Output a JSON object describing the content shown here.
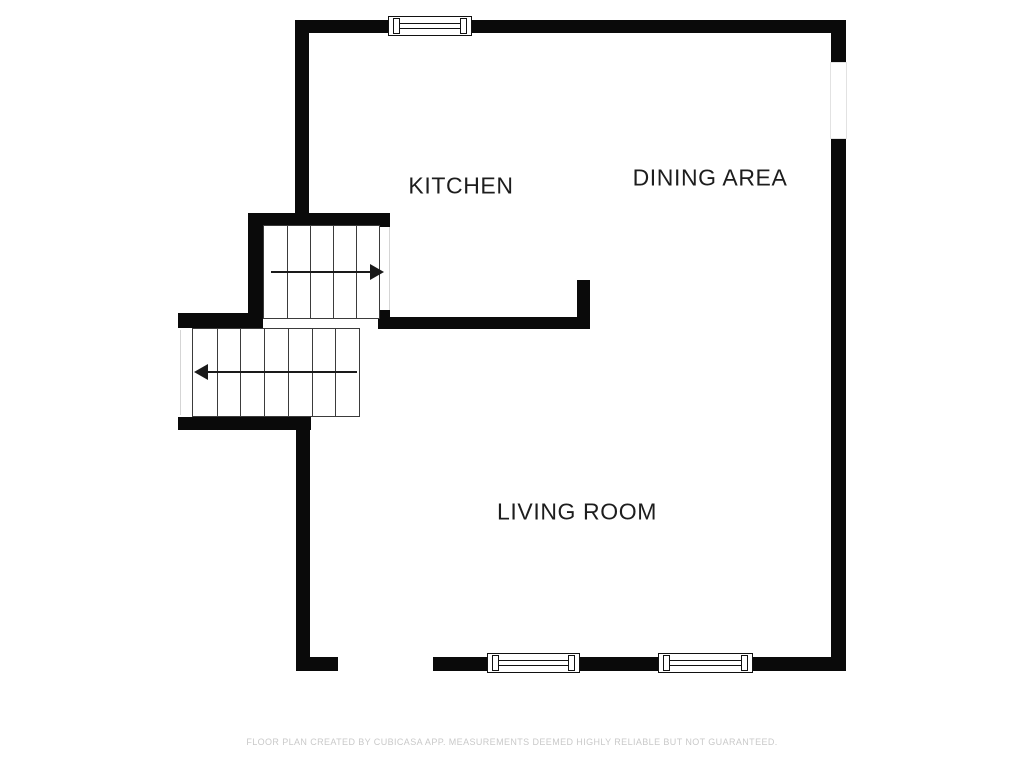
{
  "meta": {
    "canvas": {
      "width": 1024,
      "height": 768
    },
    "colors": {
      "background": "#ffffff",
      "wall": "#0a0a0a",
      "tread_line": "#3b3b3b",
      "arrow": "#1a1a1a",
      "window_frame": "#111111",
      "faint_edge": "#d5d5d5",
      "label_text": "#1d1d1d",
      "footer_text": "#c9c9c9"
    }
  },
  "rooms": [
    {
      "name": "kitchen",
      "label": "KITCHEN",
      "cx": 461,
      "cy": 186
    },
    {
      "name": "dining-area",
      "label": "DINING AREA",
      "cx": 710,
      "cy": 178
    },
    {
      "name": "living-room",
      "label": "LIVING ROOM",
      "cx": 577,
      "cy": 512
    }
  ],
  "walls": [
    {
      "name": "top-wall",
      "x": 295,
      "y": 20,
      "w": 551,
      "h": 13
    },
    {
      "name": "right-wall-upper",
      "x": 831,
      "y": 20,
      "w": 15,
      "h": 43
    },
    {
      "name": "right-wall-lower",
      "x": 831,
      "y": 139,
      "w": 15,
      "h": 531
    },
    {
      "name": "bottom-wall-left-corner",
      "x": 296,
      "y": 657,
      "w": 42,
      "h": 14
    },
    {
      "name": "bottom-wall-seg-2",
      "x": 433,
      "y": 657,
      "w": 54,
      "h": 14
    },
    {
      "name": "bottom-wall-seg-3",
      "x": 580,
      "y": 657,
      "w": 78,
      "h": 14
    },
    {
      "name": "bottom-wall-seg-4",
      "x": 753,
      "y": 657,
      "w": 93,
      "h": 14
    },
    {
      "name": "living-room-left-wall",
      "x": 296,
      "y": 430,
      "w": 14,
      "h": 241
    },
    {
      "name": "kitchen-left-wall",
      "x": 295,
      "y": 20,
      "w": 14,
      "h": 207
    },
    {
      "name": "stairs-top-wall",
      "x": 248,
      "y": 213,
      "w": 142,
      "h": 14
    },
    {
      "name": "stairs-left-wall",
      "x": 248,
      "y": 213,
      "w": 15,
      "h": 105
    },
    {
      "name": "stairs-mid-wall-left",
      "x": 178,
      "y": 313,
      "w": 85,
      "h": 15
    },
    {
      "name": "interior-wall",
      "x": 378,
      "y": 317,
      "w": 212,
      "h": 12
    },
    {
      "name": "interior-wall-nib",
      "x": 378,
      "y": 310,
      "w": 12,
      "h": 8
    },
    {
      "name": "interior-wall-stub",
      "x": 577,
      "y": 280,
      "w": 13,
      "h": 38
    },
    {
      "name": "stairs-bottom-wall",
      "x": 178,
      "y": 417,
      "w": 133,
      "h": 13
    }
  ],
  "windows": [
    {
      "name": "top-window",
      "style": "framed",
      "x": 388,
      "y": 16,
      "w": 84,
      "h": 20
    },
    {
      "name": "bottom-window-1",
      "style": "framed",
      "x": 487,
      "y": 653,
      "w": 93,
      "h": 20
    },
    {
      "name": "bottom-window-2",
      "style": "framed",
      "x": 658,
      "y": 653,
      "w": 95,
      "h": 20
    },
    {
      "name": "right-window",
      "style": "faint",
      "x": 830,
      "y": 62,
      "w": 17,
      "h": 77
    }
  ],
  "stair_edges": [
    {
      "name": "upper-stairs-open-edge",
      "x": 378,
      "y": 227,
      "w": 10,
      "h": 83
    },
    {
      "name": "lower-stairs-open-edge",
      "x": 180,
      "y": 330,
      "w": 12,
      "h": 85
    }
  ],
  "stairs": [
    {
      "name": "upper-staircase",
      "x": 263,
      "y": 225,
      "w": 115,
      "h": 92,
      "treads": 5,
      "arrow": {
        "dir": "right",
        "y": 46,
        "line_x1": 7,
        "line_x2": 108,
        "tip_x": 106
      }
    },
    {
      "name": "lower-staircase",
      "x": 192,
      "y": 328,
      "w": 166,
      "h": 87,
      "treads": 7,
      "arrow": {
        "dir": "left",
        "y": 43,
        "line_x1": 14,
        "line_x2": 164,
        "tip_x": 1
      }
    }
  ],
  "footer": {
    "text": "FLOOR PLAN CREATED BY CUBICASA APP. MEASUREMENTS DEEMED HIGHLY RELIABLE BUT NOT GUARANTEED.",
    "cx": 512,
    "cy": 742
  }
}
